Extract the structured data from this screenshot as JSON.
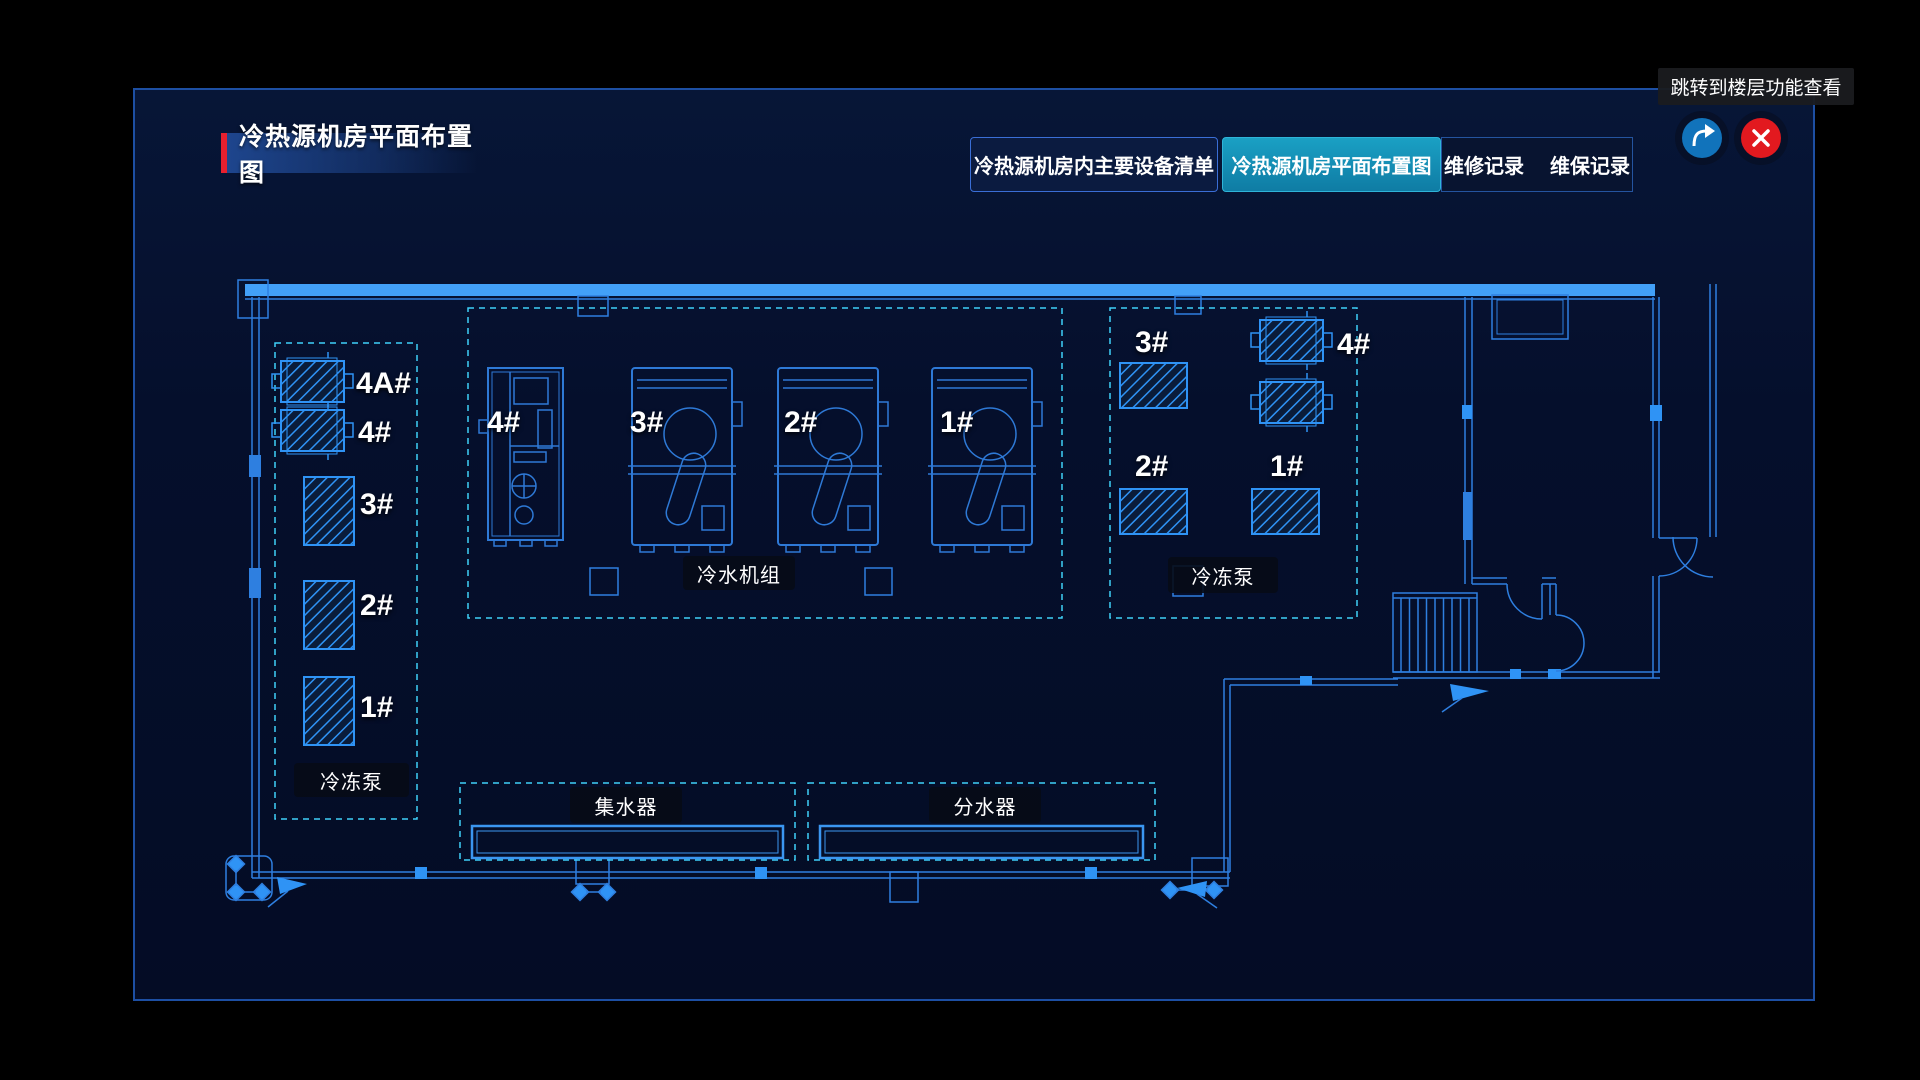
{
  "header": {
    "title": "冷热源机房平面布置图"
  },
  "tabs": {
    "equipment_list": "冷热源机房内主要设备清单",
    "floor_layout": "冷热源机房平面布置图",
    "repair_records": "维修记录",
    "maintenance_records": "维保记录",
    "active_tab": "冷热源机房平面布置图"
  },
  "tooltip": {
    "text": "跳转到楼层功能查看"
  },
  "window_controls": {
    "share_icon": "share-arrow",
    "close_icon": "close-x"
  },
  "colors": {
    "accent_red": "#E8202E",
    "active_tab_teal": "#1692B6",
    "blueprint_blue": "#2E7FE0",
    "bright_wall_blue": "#42A0F8",
    "hatch_blue": "#2F93F5",
    "dashed_cyan": "#3FD0F8",
    "share_blue": "#1173BB",
    "close_red": "#E2191F"
  },
  "floorplan": {
    "left_pumps": {
      "group_label": "冷冻泵",
      "units": [
        {
          "label": "4A#"
        },
        {
          "label": "4#"
        },
        {
          "label": "3#"
        },
        {
          "label": "2#"
        },
        {
          "label": "1#"
        }
      ]
    },
    "chillers": {
      "group_label": "冷水机组",
      "units": [
        {
          "label": "4#"
        },
        {
          "label": "3#"
        },
        {
          "label": "2#"
        },
        {
          "label": "1#"
        }
      ]
    },
    "right_pumps": {
      "group_label": "冷冻泵",
      "units": [
        {
          "label": "3#"
        },
        {
          "label": "4#"
        },
        {
          "label": "2#"
        },
        {
          "label": "1#"
        }
      ]
    },
    "collector": {
      "label": "集水器"
    },
    "distributor": {
      "label": "分水器"
    }
  }
}
